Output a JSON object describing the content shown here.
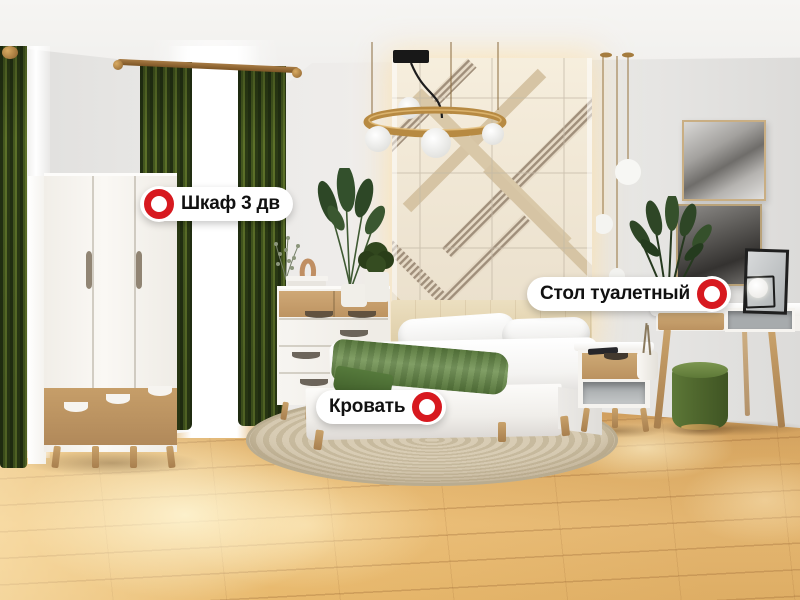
{
  "hotspots": [
    {
      "id": "wardrobe",
      "label": "Шкаф 3 дв",
      "marker_side": "left"
    },
    {
      "id": "dressing_table",
      "label": "Стол туалетный",
      "marker_side": "right"
    },
    {
      "id": "bed",
      "label": "Кровать",
      "marker_side": "right"
    }
  ],
  "colors": {
    "marker_red": "#d7191f",
    "label_bg": "#ffffff",
    "label_text": "#111111",
    "curtain_green": "#3b4e1d",
    "floor_wood": "#e2b06e",
    "wall_gray": "#e7e6e4",
    "panel_cream": "#eee3d0",
    "brass_gold": "#b9893f",
    "blanket_green": "#67884b",
    "pouf_green": "#526c2e"
  }
}
